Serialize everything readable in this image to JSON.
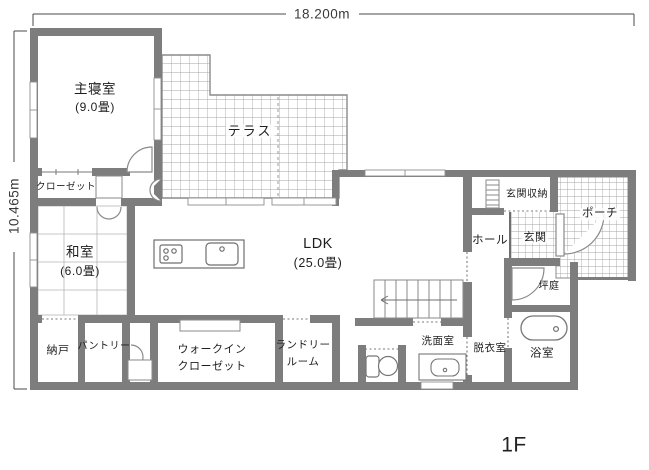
{
  "floor_plan": {
    "floor": "1F",
    "dimensions": {
      "width": "18.200m",
      "height": "10.465m"
    },
    "colors": {
      "wall": "#7d7d7d",
      "tile_line": "#a6a6a6",
      "text": "#1f1f1f"
    },
    "rooms": {
      "master": {
        "name": "主寝室",
        "size": "(9.0畳)"
      },
      "closet": {
        "name": "クローゼット"
      },
      "terrace": {
        "name": "テラス"
      },
      "washitsu": {
        "name": "和室",
        "size": "(6.0畳)"
      },
      "ldk": {
        "name": "LDK",
        "size": "(25.0畳)"
      },
      "genkan_storage": {
        "name": "玄関収納"
      },
      "porch": {
        "name": "ポーチ"
      },
      "genkan": {
        "name": "玄関"
      },
      "hall": {
        "name": "ホール"
      },
      "tsubo_niwa": {
        "name": "坪庭"
      },
      "nando": {
        "name": "納戸"
      },
      "pantry": {
        "name": "パントリー"
      },
      "wic": {
        "line1": "ウォークイン",
        "line2": "クローゼット"
      },
      "laundry": {
        "line1": "ランドリー",
        "line2": "ルーム"
      },
      "senmen": {
        "name": "洗面室"
      },
      "datsui": {
        "name": "脱衣室"
      },
      "bath": {
        "name": "浴室"
      }
    }
  }
}
